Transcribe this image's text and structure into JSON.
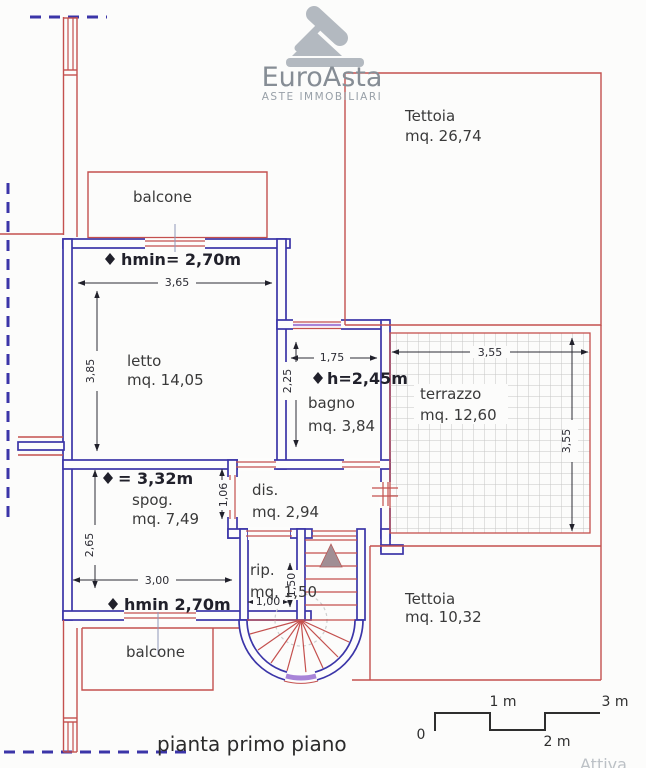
{
  "logo": {
    "brand": "EuroAsta",
    "subtitle": "ASTE IMMOBILIARI",
    "icon": "gavel-icon"
  },
  "plan": {
    "title": "pianta primo piano",
    "watermark": "Attiva"
  },
  "rooms": {
    "tettoia_top": {
      "name": "Tettoia",
      "area": "mq. 26,74"
    },
    "balcone_top": {
      "name": "balcone"
    },
    "letto": {
      "name": "letto",
      "area": "mq. 14,05"
    },
    "bagno": {
      "name": "bagno",
      "area": "mq. 3,84"
    },
    "terrazzo": {
      "name": "terrazzo",
      "area": "mq. 12,60"
    },
    "spog": {
      "name": "spog.",
      "area": "mq. 7,49"
    },
    "dis": {
      "name": "dis.",
      "area": "mq. 2,94"
    },
    "rip": {
      "name": "rip.",
      "area": "mq. 1,50"
    },
    "tettoia_bottom": {
      "name": "Tettoia",
      "area": "mq. 10,32"
    },
    "balcone_bottom": {
      "name": "balcone"
    }
  },
  "annotations": {
    "letto_hmin": "hmin= 2,70m",
    "bagno_h": "h=2,45m",
    "spog_h": "= 3,32m",
    "spog_hmin": "hmin 2,70m"
  },
  "dimensions": {
    "letto_width": "3,65",
    "letto_height": "3,85",
    "bagno_width": "1,75",
    "bagno_height": "2,25",
    "terrazzo_width": "3,55",
    "terrazzo_height": "3,55",
    "spog_width": "3,00",
    "spog_height": "2,65",
    "dis_dim": "1,06",
    "rip_width": "1,00",
    "rip_height": "1,50"
  },
  "scale_bar": {
    "start": "0",
    "m1": "1 m",
    "m2": "2 m",
    "m3": "3 m"
  },
  "colors": {
    "wall_blue": "#3b35a8",
    "line_red": "#c4504e",
    "window_purple": "#a884d8",
    "dim_dark": "#2c2c34",
    "logo_gray": "#9aa1a8",
    "grid_gray": "#c6c6c6"
  }
}
